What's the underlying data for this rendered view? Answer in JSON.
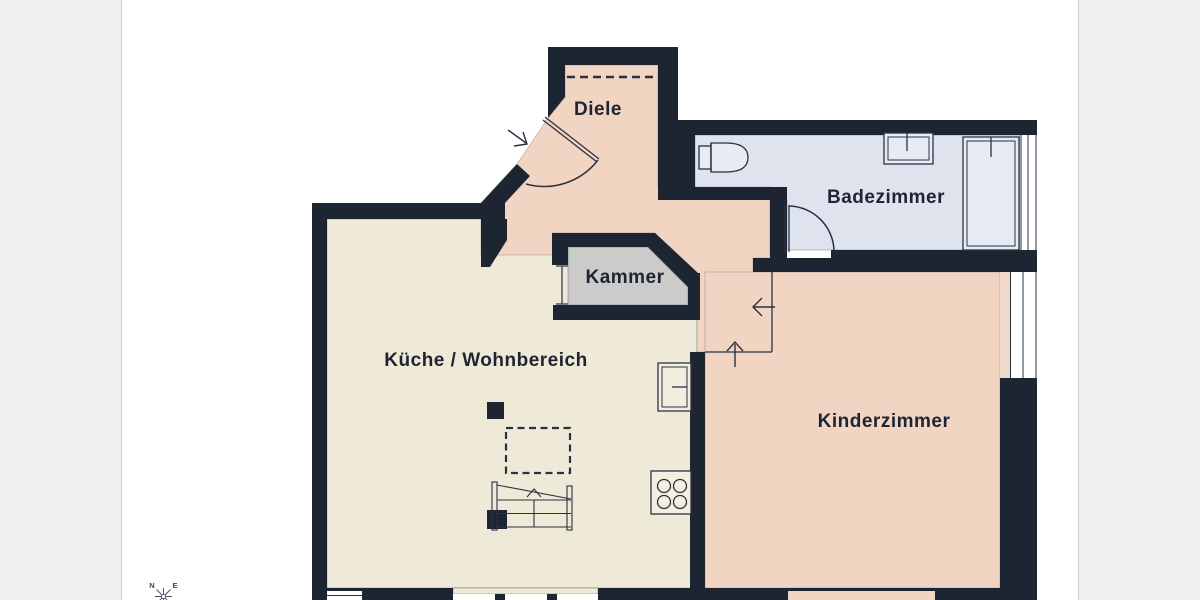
{
  "page": {
    "margin_color": "#f0f0f0",
    "surface_color": "#ffffff",
    "border_color": "#d6d6d6"
  },
  "floorplan": {
    "wall_color": "#1e2532",
    "line_color": "#2a3242",
    "window_fill": "#ffffff",
    "fixture_fill": "#e7ebf3",
    "kitchen_fixture_fill": "#f3eee0",
    "sill_color": "#f0d9cb",
    "rooms": [
      {
        "id": "diele",
        "label": "Diele",
        "floor_color": "#f2d4c3"
      },
      {
        "id": "badezimmer",
        "label": "Badezimmer",
        "floor_color": "#dee3ed"
      },
      {
        "id": "kammer",
        "label": "Kammer",
        "floor_color": "#cbcbca"
      },
      {
        "id": "kueche-wohnbereich",
        "label": "Küche / Wohnbereich",
        "floor_color": "#efe9d7"
      },
      {
        "id": "kinderzimmer",
        "label": "Kinderzimmer",
        "floor_color": "#f2d4c3"
      }
    ],
    "compass": {
      "north_label": "N",
      "east_label": "E"
    }
  }
}
